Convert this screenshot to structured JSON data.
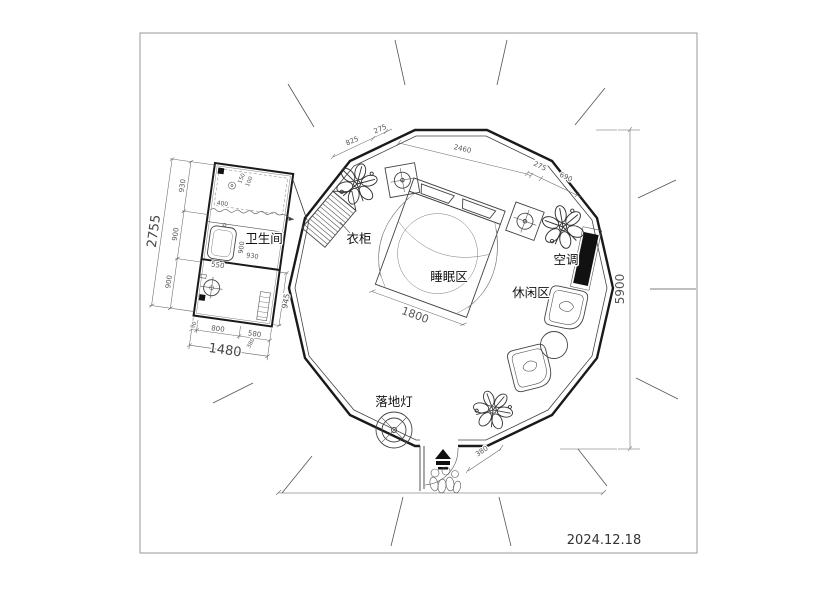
{
  "meta": {
    "date": "2024.12.18",
    "drawing_type": "yurt-floor-plan"
  },
  "rooms": {
    "bathroom": "卫生间",
    "wardrobe": "衣柜",
    "sleeping": "睡眠区",
    "ac": "空调",
    "leisure": "休闲区",
    "floor_lamp": "落地灯"
  },
  "dimensions": {
    "top": [
      "825",
      "275",
      "2460",
      "45",
      "275",
      "690"
    ],
    "right_overall": "5900",
    "bed_width": "1800",
    "entrance": "380",
    "bathroom": {
      "left_overall": "2755",
      "left_chain": [
        "930",
        "900",
        "900"
      ],
      "bottom_chain": [
        "90",
        "800",
        "580"
      ],
      "bottom_overall": "1480",
      "bottom_extra": "380",
      "right": "945",
      "inner": [
        "400",
        "150",
        "100",
        "550",
        "900",
        "930"
      ]
    }
  },
  "colors": {
    "wall": "#1a1a1a",
    "line": "#444444",
    "dimension": "#555555",
    "label": "#111111",
    "ac_fill": "#111111",
    "background": "#ffffff",
    "frame": "#999999"
  }
}
